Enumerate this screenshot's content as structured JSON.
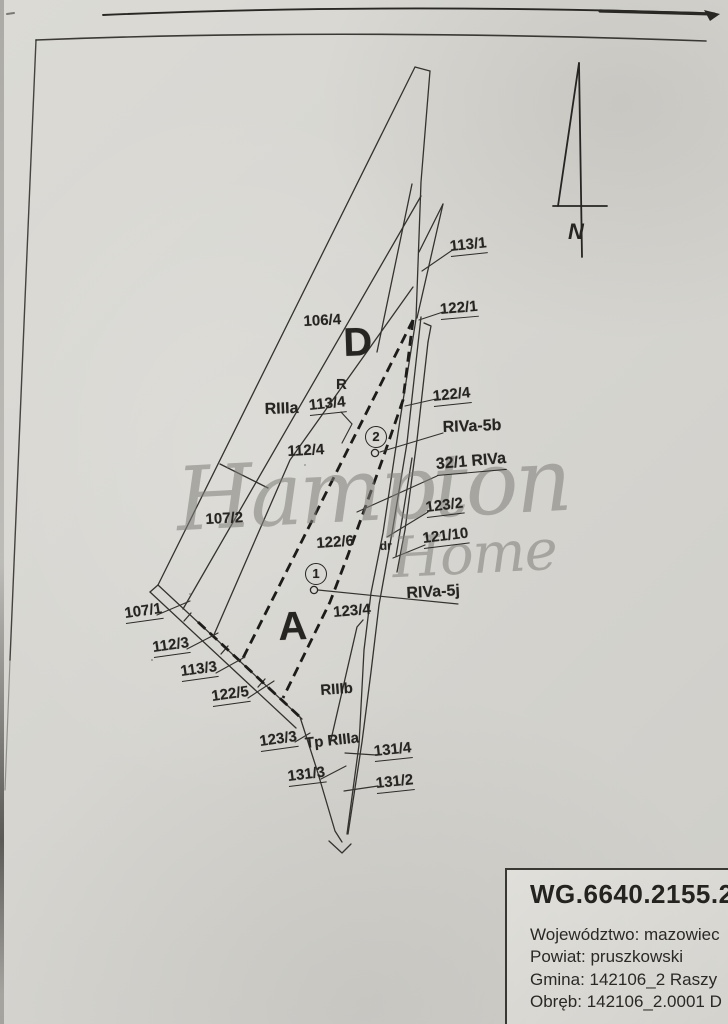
{
  "north": {
    "label": "N"
  },
  "watermark": {
    "word1": "Hampton",
    "word2": "Home"
  },
  "registry": {
    "case_number": "WG.6640.2155.20",
    "lines": [
      "Województwo: mazowiec",
      "Powiat: pruszkowski",
      "Gmina: 142106_2 Raszy",
      "Obręb: 142106_2.0001 D"
    ]
  },
  "map": {
    "labels": [
      {
        "id": "113-1",
        "text": "113/1",
        "x": 451,
        "y": 239,
        "rot": -6,
        "ul": true
      },
      {
        "id": "122-1",
        "text": "122/1",
        "x": 441,
        "y": 302,
        "rot": -5,
        "ul": true
      },
      {
        "id": "106-4",
        "text": "106/4",
        "x": 304,
        "y": 314,
        "rot": -3
      },
      {
        "id": "region-d",
        "text": "D",
        "x": 344,
        "y": 322,
        "size": 40,
        "rot": -2
      },
      {
        "id": "r-class",
        "text": "R",
        "x": 336,
        "y": 377,
        "size": 15
      },
      {
        "id": "riiia",
        "text": "RIIIa",
        "x": 265,
        "y": 402,
        "size": 16,
        "rot": -2
      },
      {
        "id": "113-4",
        "text": "113/4",
        "x": 310,
        "y": 398,
        "rot": -6,
        "ul": true
      },
      {
        "id": "112-4",
        "text": "112/4",
        "x": 288,
        "y": 444,
        "rot": -3
      },
      {
        "id": "122-4",
        "text": "122/4",
        "x": 434,
        "y": 389,
        "rot": -6,
        "ul": true
      },
      {
        "id": "riva-5b",
        "text": "RIVa-5b",
        "x": 443,
        "y": 420,
        "size": 16,
        "rot": -2
      },
      {
        "id": "32-1-riva",
        "text": "32/1 RIVa",
        "x": 437,
        "y": 457,
        "size": 16,
        "rot": -5,
        "ul": true
      },
      {
        "id": "123-2",
        "text": "123/2",
        "x": 427,
        "y": 500,
        "rot": -7,
        "ul": true
      },
      {
        "id": "121-10",
        "text": "121/10",
        "x": 424,
        "y": 531,
        "rot": -7,
        "ul": true
      },
      {
        "id": "107-2",
        "text": "107/2",
        "x": 206,
        "y": 512,
        "rot": -3
      },
      {
        "id": "122-6",
        "text": "122/6",
        "x": 317,
        "y": 536,
        "rot": -4
      },
      {
        "id": "dr",
        "text": "dr",
        "x": 380,
        "y": 540,
        "size": 12,
        "rot": -2
      },
      {
        "id": "point-2",
        "text": "2",
        "x": 365,
        "y": 426,
        "circle": true
      },
      {
        "id": "point-1",
        "text": "1",
        "x": 305,
        "y": 563,
        "circle": true
      },
      {
        "id": "riva-5j",
        "text": "RIVa-5j",
        "x": 407,
        "y": 586,
        "size": 16,
        "rot": -3
      },
      {
        "id": "123-4",
        "text": "123/4",
        "x": 334,
        "y": 605,
        "rot": -5
      },
      {
        "id": "region-a",
        "text": "A",
        "x": 279,
        "y": 606,
        "size": 40,
        "rot": -2
      },
      {
        "id": "107-1",
        "text": "107/1",
        "x": 126,
        "y": 606,
        "rot": -8,
        "ul": true
      },
      {
        "id": "112-3",
        "text": "112/3",
        "x": 154,
        "y": 640,
        "rot": -8,
        "ul": true
      },
      {
        "id": "113-3",
        "text": "113/3",
        "x": 182,
        "y": 664,
        "rot": -8,
        "ul": true
      },
      {
        "id": "122-5",
        "text": "122/5",
        "x": 213,
        "y": 689,
        "rot": -8,
        "ul": true
      },
      {
        "id": "riiib",
        "text": "RIIIb",
        "x": 321,
        "y": 683,
        "size": 15,
        "rot": -4
      },
      {
        "id": "123-3",
        "text": "123/3",
        "x": 261,
        "y": 734,
        "rot": -8,
        "ul": true
      },
      {
        "id": "tp-riiia",
        "text": "Tp RIIIa",
        "x": 306,
        "y": 736,
        "size": 15,
        "rot": -6
      },
      {
        "id": "131-4",
        "text": "131/4",
        "x": 375,
        "y": 744,
        "rot": -6,
        "ul": true
      },
      {
        "id": "131-3",
        "text": "131/3",
        "x": 289,
        "y": 769,
        "rot": -7,
        "ul": true
      },
      {
        "id": "131-2",
        "text": "131/2",
        "x": 377,
        "y": 776,
        "rot": -6,
        "ul": true
      }
    ]
  },
  "colors": {
    "ink": "#35332f",
    "dashed_boundary": "#1d1c1a",
    "paper": "#d7d6d1",
    "watermark": "#807f7a"
  }
}
